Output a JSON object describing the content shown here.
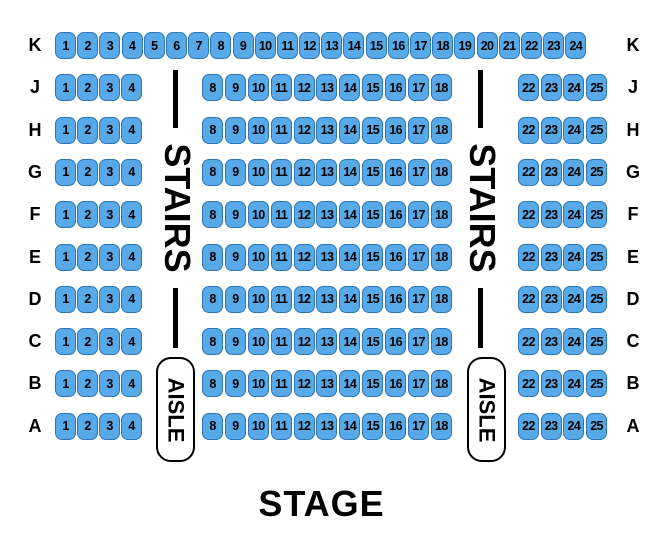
{
  "colors": {
    "seat_fill": "#58A9E8",
    "seat_border": "#2E75B6",
    "ink": "#000000",
    "background": "#FFFFFF"
  },
  "labels": {
    "stage": "STAGE",
    "stairs": "STAIRS",
    "aisle": "AISLE"
  },
  "rows": [
    {
      "label": "K",
      "groups": {
        "full": [
          "1",
          "2",
          "3",
          "4",
          "5",
          "6",
          "7",
          "8",
          "9",
          "10",
          "11",
          "12",
          "13",
          "14",
          "15",
          "16",
          "17",
          "18",
          "19",
          "20",
          "21",
          "22",
          "23",
          "24"
        ]
      }
    },
    {
      "label": "J",
      "groups": {
        "left": [
          "1",
          "2",
          "3",
          "4"
        ],
        "middle": [
          "8",
          "9",
          "10",
          "11",
          "12",
          "13",
          "14",
          "15",
          "16",
          "17",
          "18"
        ],
        "right": [
          "22",
          "23",
          "24",
          "25"
        ]
      }
    },
    {
      "label": "H",
      "groups": {
        "left": [
          "1",
          "2",
          "3",
          "4"
        ],
        "middle": [
          "8",
          "9",
          "10",
          "11",
          "12",
          "13",
          "14",
          "15",
          "16",
          "17",
          "18"
        ],
        "right": [
          "22",
          "23",
          "24",
          "25"
        ]
      }
    },
    {
      "label": "G",
      "groups": {
        "left": [
          "1",
          "2",
          "3",
          "4"
        ],
        "middle": [
          "8",
          "9",
          "10",
          "11",
          "12",
          "13",
          "14",
          "15",
          "16",
          "17",
          "18"
        ],
        "right": [
          "22",
          "23",
          "24",
          "25"
        ]
      }
    },
    {
      "label": "F",
      "groups": {
        "left": [
          "1",
          "2",
          "3",
          "4"
        ],
        "middle": [
          "8",
          "9",
          "10",
          "11",
          "12",
          "13",
          "14",
          "15",
          "16",
          "17",
          "18"
        ],
        "right": [
          "22",
          "23",
          "24",
          "25"
        ]
      }
    },
    {
      "label": "E",
      "groups": {
        "left": [
          "1",
          "2",
          "3",
          "4"
        ],
        "middle": [
          "8",
          "9",
          "10",
          "11",
          "12",
          "13",
          "14",
          "15",
          "16",
          "17",
          "18"
        ],
        "right": [
          "22",
          "23",
          "24",
          "25"
        ]
      }
    },
    {
      "label": "D",
      "groups": {
        "left": [
          "1",
          "2",
          "3",
          "4"
        ],
        "middle": [
          "8",
          "9",
          "10",
          "11",
          "12",
          "13",
          "14",
          "15",
          "16",
          "17",
          "18"
        ],
        "right": [
          "22",
          "23",
          "24",
          "25"
        ]
      }
    },
    {
      "label": "C",
      "groups": {
        "left": [
          "1",
          "2",
          "3",
          "4"
        ],
        "middle": [
          "8",
          "9",
          "10",
          "11",
          "12",
          "13",
          "14",
          "15",
          "16",
          "17",
          "18"
        ],
        "right": [
          "22",
          "23",
          "24",
          "25"
        ]
      }
    },
    {
      "label": "B",
      "groups": {
        "left": [
          "1",
          "2",
          "3",
          "4"
        ],
        "middle": [
          "8",
          "9",
          "10",
          "11",
          "12",
          "13",
          "14",
          "15",
          "16",
          "17",
          "18"
        ],
        "right": [
          "22",
          "23",
          "24",
          "25"
        ]
      }
    },
    {
      "label": "A",
      "groups": {
        "left": [
          "1",
          "2",
          "3",
          "4"
        ],
        "middle": [
          "8",
          "9",
          "10",
          "11",
          "12",
          "13",
          "14",
          "15",
          "16",
          "17",
          "18"
        ],
        "right": [
          "22",
          "23",
          "24",
          "25"
        ]
      }
    }
  ]
}
